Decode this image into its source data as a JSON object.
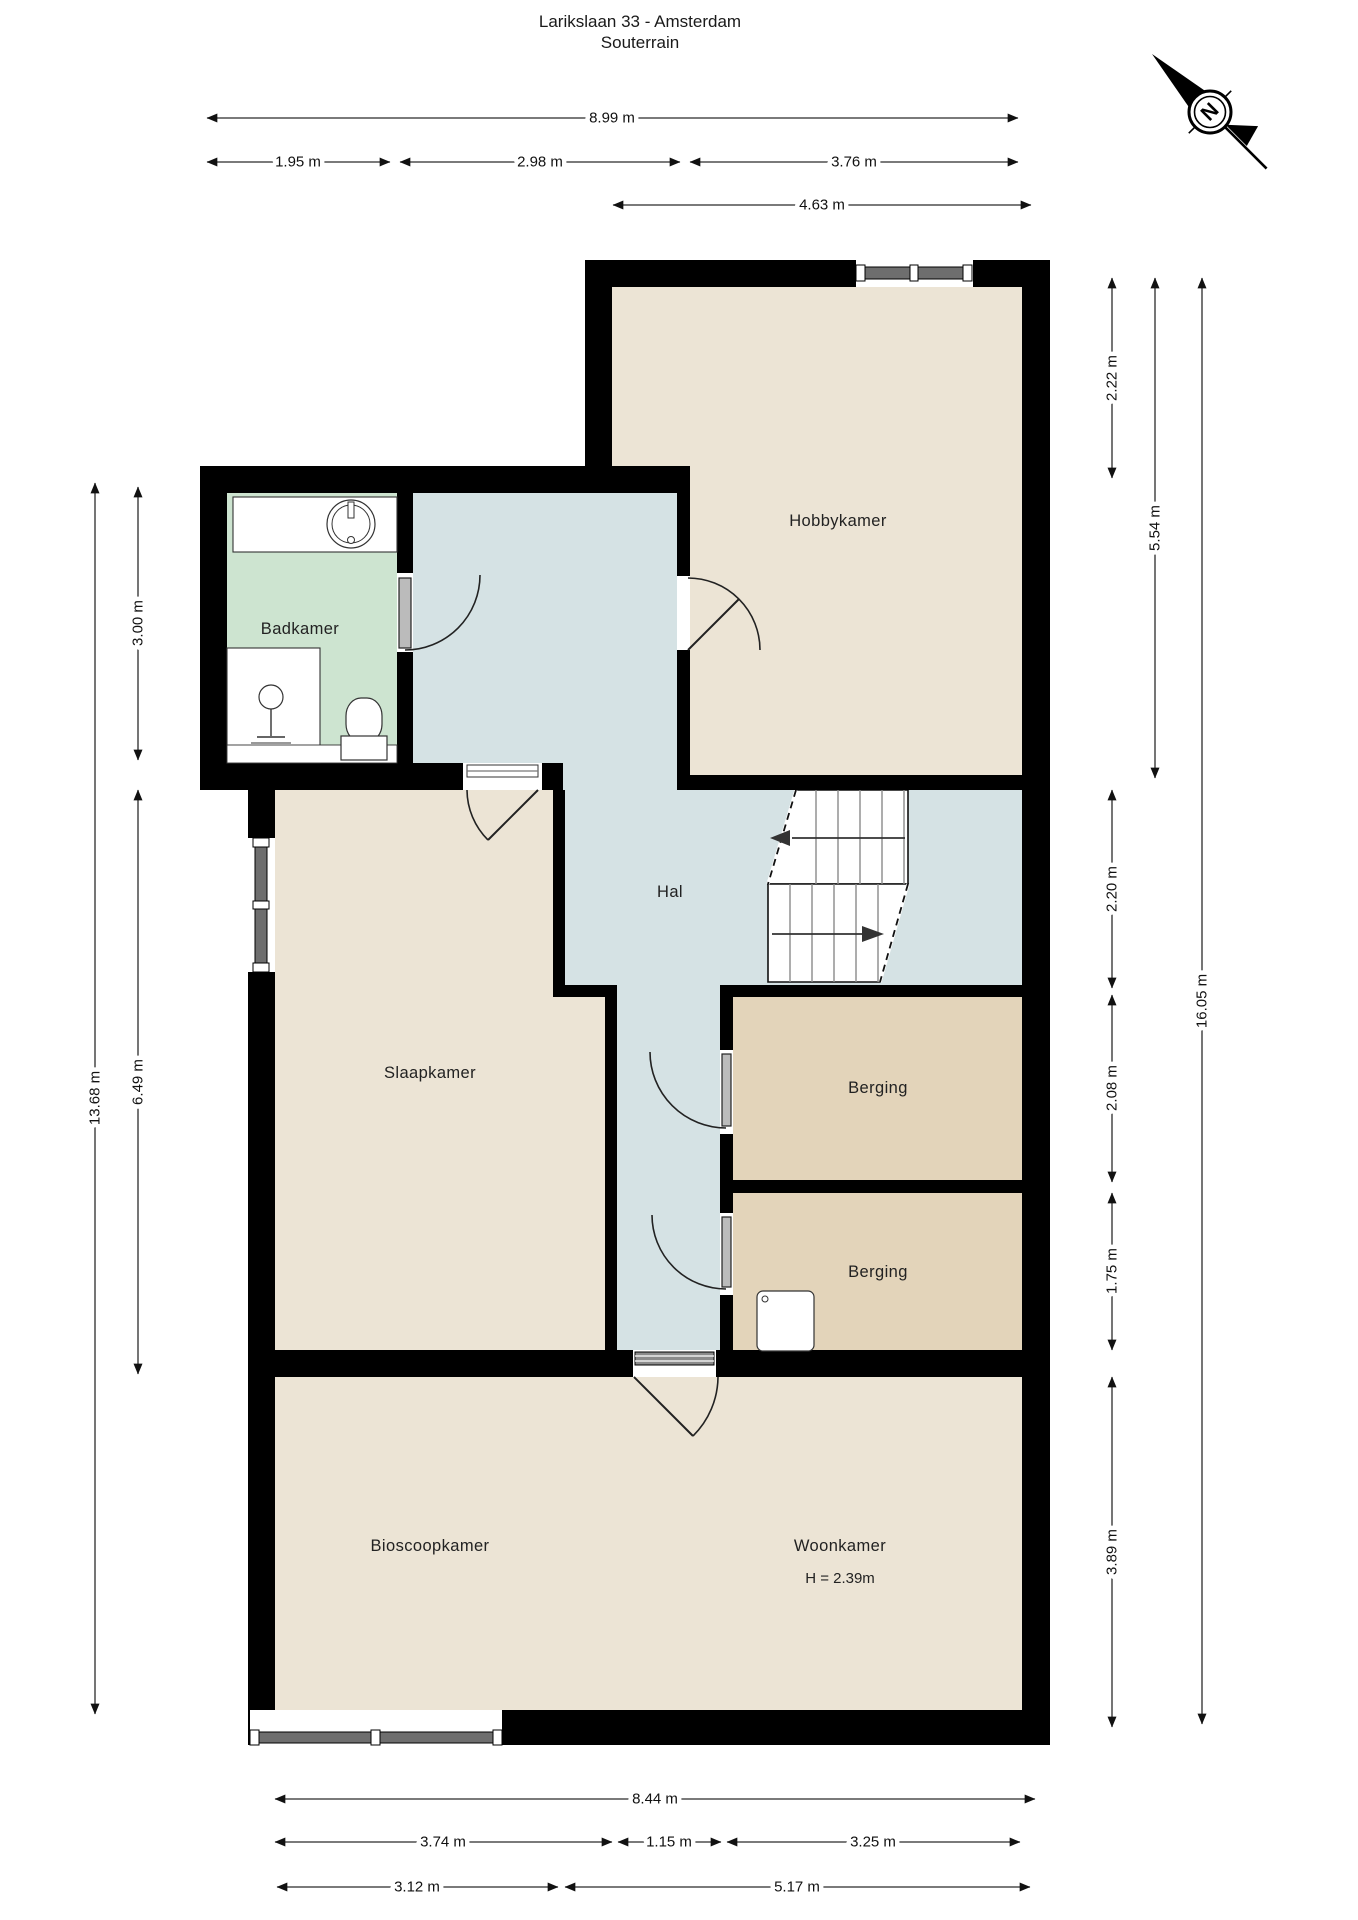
{
  "page": {
    "title_line1": "Larikslaan 33 - Amsterdam",
    "title_line2": "Souterrain"
  },
  "compass": {
    "north_label": "N"
  },
  "rooms": {
    "hobbykamer": {
      "label": "Hobbykamer"
    },
    "badkamer": {
      "label": "Badkamer"
    },
    "hal": {
      "label": "Hal"
    },
    "slaapkamer": {
      "label": "Slaapkamer"
    },
    "berging_boven": {
      "label": "Berging"
    },
    "berging_onder": {
      "label": "Berging"
    },
    "bioscoopkamer": {
      "label": "Bioscoopkamer"
    },
    "woonkamer": {
      "label": "Woonkamer",
      "ceiling_height": "H = 2.39m"
    }
  },
  "dimensions": {
    "top": [
      {
        "label": "8.99 m"
      },
      {
        "label": "1.95 m"
      },
      {
        "label": "2.98 m"
      },
      {
        "label": "3.76 m"
      },
      {
        "label": "4.63 m"
      }
    ],
    "bottom": [
      {
        "label": "8.44 m"
      },
      {
        "label": "3.74 m"
      },
      {
        "label": "1.15 m"
      },
      {
        "label": "3.25 m"
      },
      {
        "label": "3.12 m"
      },
      {
        "label": "5.17 m"
      }
    ],
    "left": [
      {
        "label": "13.68 m"
      },
      {
        "label": "3.00 m"
      },
      {
        "label": "6.49 m"
      }
    ],
    "right": [
      {
        "label": "2.22 m"
      },
      {
        "label": "5.54 m"
      },
      {
        "label": "2.20 m"
      },
      {
        "label": "2.08 m"
      },
      {
        "label": "1.75 m"
      },
      {
        "label": "3.89 m"
      },
      {
        "label": "16.05 m"
      }
    ]
  },
  "colors": {
    "wall": "#000000",
    "room_default": "#ece4d5",
    "room_storage": "#e3d4ba",
    "room_bath": "#cde4d0",
    "room_hall": "#d5e2e4"
  }
}
